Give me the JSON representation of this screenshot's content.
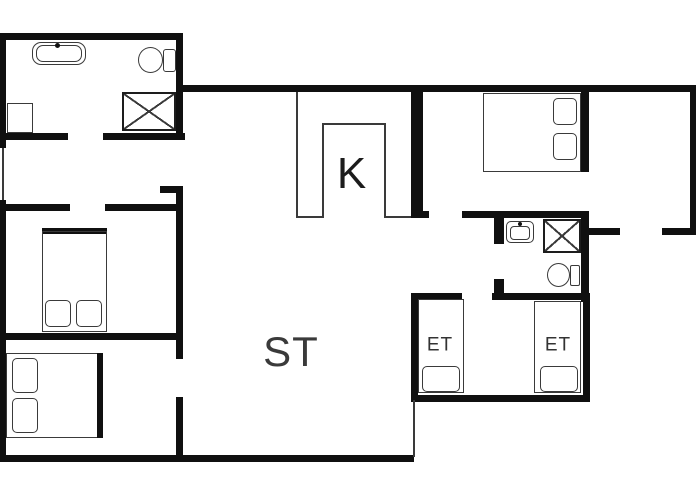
{
  "title": "floor-plan",
  "colors": {
    "wall": "#101010",
    "line": "#3a3a3a",
    "background": "#ffffff",
    "label": "#2b2b2b"
  },
  "labels": [
    {
      "id": "kitchen",
      "text": "K",
      "x": 352,
      "y": 174,
      "size": 44,
      "color": "#1c1c1c"
    },
    {
      "id": "living-room",
      "text": "ST",
      "x": 291,
      "y": 352,
      "size": 42,
      "color": "#3a3a3a"
    },
    {
      "id": "single-bedroom-left",
      "text": "ET",
      "x": 440,
      "y": 345,
      "size": 19,
      "color": "#333333"
    },
    {
      "id": "single-bedroom-right",
      "text": "ET",
      "x": 558,
      "y": 345,
      "size": 19,
      "color": "#333333"
    }
  ],
  "walls": [
    {
      "name": "top-wall-left-block",
      "type": "thick",
      "x": 0,
      "y": 33,
      "w": 183,
      "h": 7
    },
    {
      "name": "left-wall-upper",
      "type": "thick",
      "x": 0,
      "y": 33,
      "w": 6,
      "h": 115
    },
    {
      "name": "left-wall-window",
      "type": "thin",
      "x": 2,
      "y": 148,
      "w": 2,
      "h": 52
    },
    {
      "name": "left-wall-lower",
      "type": "thick",
      "x": 0,
      "y": 200,
      "w": 6,
      "h": 262
    },
    {
      "name": "bath1-right-wall",
      "type": "thick",
      "x": 176,
      "y": 33,
      "w": 7,
      "h": 107
    },
    {
      "name": "main-top-wall",
      "type": "thick",
      "x": 176,
      "y": 85,
      "w": 520,
      "h": 7
    },
    {
      "name": "right-outer-wall",
      "type": "thick",
      "x": 690,
      "y": 85,
      "w": 6,
      "h": 150
    },
    {
      "name": "entry-bottom-wall-a",
      "type": "thick",
      "x": 589,
      "y": 228,
      "w": 31,
      "h": 7
    },
    {
      "name": "entry-bottom-wall-b",
      "type": "thick",
      "x": 662,
      "y": 228,
      "w": 34,
      "h": 7
    },
    {
      "name": "bedroom-entry-divider-up",
      "type": "thick",
      "x": 581,
      "y": 85,
      "w": 8,
      "h": 87
    },
    {
      "name": "bedroom-entry-divider-dn",
      "type": "thick",
      "x": 581,
      "y": 211,
      "w": 8,
      "h": 91
    },
    {
      "name": "bath2-top-wall",
      "type": "thick",
      "x": 462,
      "y": 211,
      "w": 127,
      "h": 7
    },
    {
      "name": "kitchen-right-wall",
      "type": "thick",
      "x": 411,
      "y": 85,
      "w": 12,
      "h": 133
    },
    {
      "name": "kitchen-wall-foot",
      "type": "thick",
      "x": 411,
      "y": 211,
      "w": 18,
      "h": 7
    },
    {
      "name": "bath2-door-jamb-upper",
      "type": "thick",
      "x": 494,
      "y": 218,
      "w": 10,
      "h": 26
    },
    {
      "name": "bath2-door-jamb-lower",
      "type": "thick",
      "x": 494,
      "y": 279,
      "w": 10,
      "h": 21
    },
    {
      "name": "bath2-bottom-wall",
      "type": "thick",
      "x": 492,
      "y": 293,
      "w": 93,
      "h": 7
    },
    {
      "name": "et-top-wall",
      "type": "thick",
      "x": 411,
      "y": 293,
      "w": 51,
      "h": 7
    },
    {
      "name": "et-left-wall",
      "type": "thick",
      "x": 411,
      "y": 293,
      "w": 7,
      "h": 109
    },
    {
      "name": "et-bottom-wall",
      "type": "thick",
      "x": 411,
      "y": 395,
      "w": 179,
      "h": 7
    },
    {
      "name": "et-right-wall",
      "type": "thick",
      "x": 583,
      "y": 293,
      "w": 7,
      "h": 109
    },
    {
      "name": "st-bottom-wall",
      "type": "thick",
      "x": 0,
      "y": 455,
      "w": 414,
      "h": 7
    },
    {
      "name": "st-step-line",
      "type": "thin",
      "x": 413,
      "y": 400,
      "w": 2,
      "h": 57
    },
    {
      "name": "hall-wall-upper",
      "type": "thick",
      "x": 176,
      "y": 186,
      "w": 7,
      "h": 173
    },
    {
      "name": "hall-wall-foot",
      "type": "thick",
      "x": 160,
      "y": 186,
      "w": 23,
      "h": 7
    },
    {
      "name": "hall-wall-lower",
      "type": "thick",
      "x": 176,
      "y": 397,
      "w": 7,
      "h": 60
    },
    {
      "name": "bath1-bottom-wall-a",
      "type": "thick",
      "x": 0,
      "y": 133,
      "w": 68,
      "h": 7
    },
    {
      "name": "bath1-bottom-wall-b",
      "type": "thick",
      "x": 103,
      "y": 133,
      "w": 82,
      "h": 7
    },
    {
      "name": "bedroom2-top-wall-a",
      "type": "thick",
      "x": 6,
      "y": 204,
      "w": 64,
      "h": 7
    },
    {
      "name": "bedroom2-top-wall-b",
      "type": "thick",
      "x": 105,
      "y": 204,
      "w": 75,
      "h": 7
    },
    {
      "name": "bedroom-divider-wall",
      "type": "thick",
      "x": 0,
      "y": 333,
      "w": 177,
      "h": 7
    },
    {
      "name": "kitchen-left-line",
      "type": "thin",
      "x": 296,
      "y": 92,
      "w": 2,
      "h": 126
    },
    {
      "name": "counter-inner-left",
      "type": "thin",
      "x": 322,
      "y": 123,
      "w": 2,
      "h": 95
    },
    {
      "name": "counter-inner-top",
      "type": "thin",
      "x": 322,
      "y": 123,
      "w": 63,
      "h": 2
    },
    {
      "name": "counter-inner-right",
      "type": "thin",
      "x": 384,
      "y": 123,
      "w": 2,
      "h": 95
    },
    {
      "name": "counter-bottom-left",
      "type": "thin",
      "x": 296,
      "y": 216,
      "w": 27,
      "h": 2
    },
    {
      "name": "counter-bottom-right",
      "type": "thin",
      "x": 384,
      "y": 216,
      "w": 27,
      "h": 2
    }
  ],
  "fixtures": [
    {
      "name": "bathtub-outer",
      "type": "rect",
      "x": 32,
      "y": 42,
      "w": 54,
      "h": 23,
      "r": 9
    },
    {
      "name": "bathtub-inner",
      "type": "rect",
      "x": 36,
      "y": 45,
      "w": 46,
      "h": 17,
      "r": 7
    },
    {
      "name": "bathtub-faucet-dot",
      "type": "dot",
      "x": 55,
      "y": 43,
      "w": 5,
      "h": 5
    },
    {
      "name": "bath1-cabinet",
      "type": "rect",
      "x": 7,
      "y": 103,
      "w": 26,
      "h": 30,
      "r": 0
    },
    {
      "name": "bath1-toilet-bowl",
      "type": "ellipse",
      "x": 138,
      "y": 47,
      "w": 25,
      "h": 26
    },
    {
      "name": "bath1-toilet-tank",
      "type": "rect",
      "x": 163,
      "y": 49,
      "w": 13,
      "h": 23,
      "r": 3
    },
    {
      "name": "bath1-shower",
      "type": "xbox",
      "x": 122,
      "y": 92,
      "w": 54,
      "h": 39
    },
    {
      "name": "bath2-sink-outer",
      "type": "rect",
      "x": 506,
      "y": 221,
      "w": 28,
      "h": 22,
      "r": 5
    },
    {
      "name": "bath2-sink-bowl",
      "type": "rect",
      "x": 510,
      "y": 226,
      "w": 20,
      "h": 14,
      "r": 4
    },
    {
      "name": "bath2-sink-faucet-dot",
      "type": "dot",
      "x": 518,
      "y": 222,
      "w": 4,
      "h": 4
    },
    {
      "name": "bath2-shower",
      "type": "xbox",
      "x": 543,
      "y": 219,
      "w": 38,
      "h": 34
    },
    {
      "name": "bath2-toilet-bowl",
      "type": "ellipse",
      "x": 547,
      "y": 263,
      "w": 23,
      "h": 24
    },
    {
      "name": "bath2-toilet-tank",
      "type": "rect",
      "x": 570,
      "y": 265,
      "w": 10,
      "h": 21,
      "r": 2
    },
    {
      "name": "bed-topright-outline",
      "type": "rect",
      "x": 483,
      "y": 93,
      "w": 98,
      "h": 79,
      "r": 0
    },
    {
      "name": "bed-topright-pillow-1",
      "type": "rect",
      "x": 553,
      "y": 98,
      "w": 24,
      "h": 27,
      "r": 5
    },
    {
      "name": "bed-topright-pillow-2",
      "type": "rect",
      "x": 553,
      "y": 133,
      "w": 24,
      "h": 27,
      "r": 5
    },
    {
      "name": "bed-midleft-headboard",
      "type": "bar",
      "x": 42,
      "y": 228,
      "w": 65,
      "h": 6
    },
    {
      "name": "bed-midleft-outline",
      "type": "rect",
      "x": 42,
      "y": 231,
      "w": 65,
      "h": 101,
      "r": 0
    },
    {
      "name": "bed-midleft-pillow-1",
      "type": "rect",
      "x": 45,
      "y": 300,
      "w": 26,
      "h": 27,
      "r": 5
    },
    {
      "name": "bed-midleft-pillow-2",
      "type": "rect",
      "x": 76,
      "y": 300,
      "w": 26,
      "h": 27,
      "r": 5
    },
    {
      "name": "bed-botleft-outline",
      "type": "rect",
      "x": 6,
      "y": 353,
      "w": 97,
      "h": 85,
      "r": 0
    },
    {
      "name": "bed-botleft-footboard",
      "type": "bar",
      "x": 97,
      "y": 353,
      "w": 6,
      "h": 85
    },
    {
      "name": "bed-botleft-pillow-1",
      "type": "rect",
      "x": 12,
      "y": 358,
      "w": 26,
      "h": 35,
      "r": 5
    },
    {
      "name": "bed-botleft-pillow-2",
      "type": "rect",
      "x": 12,
      "y": 398,
      "w": 26,
      "h": 35,
      "r": 5
    },
    {
      "name": "bed-et-left-outline",
      "type": "rect",
      "x": 418,
      "y": 299,
      "w": 46,
      "h": 94,
      "r": 0
    },
    {
      "name": "bed-et-left-pillow",
      "type": "rect",
      "x": 422,
      "y": 366,
      "w": 38,
      "h": 26,
      "r": 5
    },
    {
      "name": "bed-et-right-outline",
      "type": "rect",
      "x": 534,
      "y": 301,
      "w": 47,
      "h": 92,
      "r": 0
    },
    {
      "name": "bed-et-right-pillow",
      "type": "rect",
      "x": 540,
      "y": 366,
      "w": 38,
      "h": 26,
      "r": 5
    }
  ]
}
